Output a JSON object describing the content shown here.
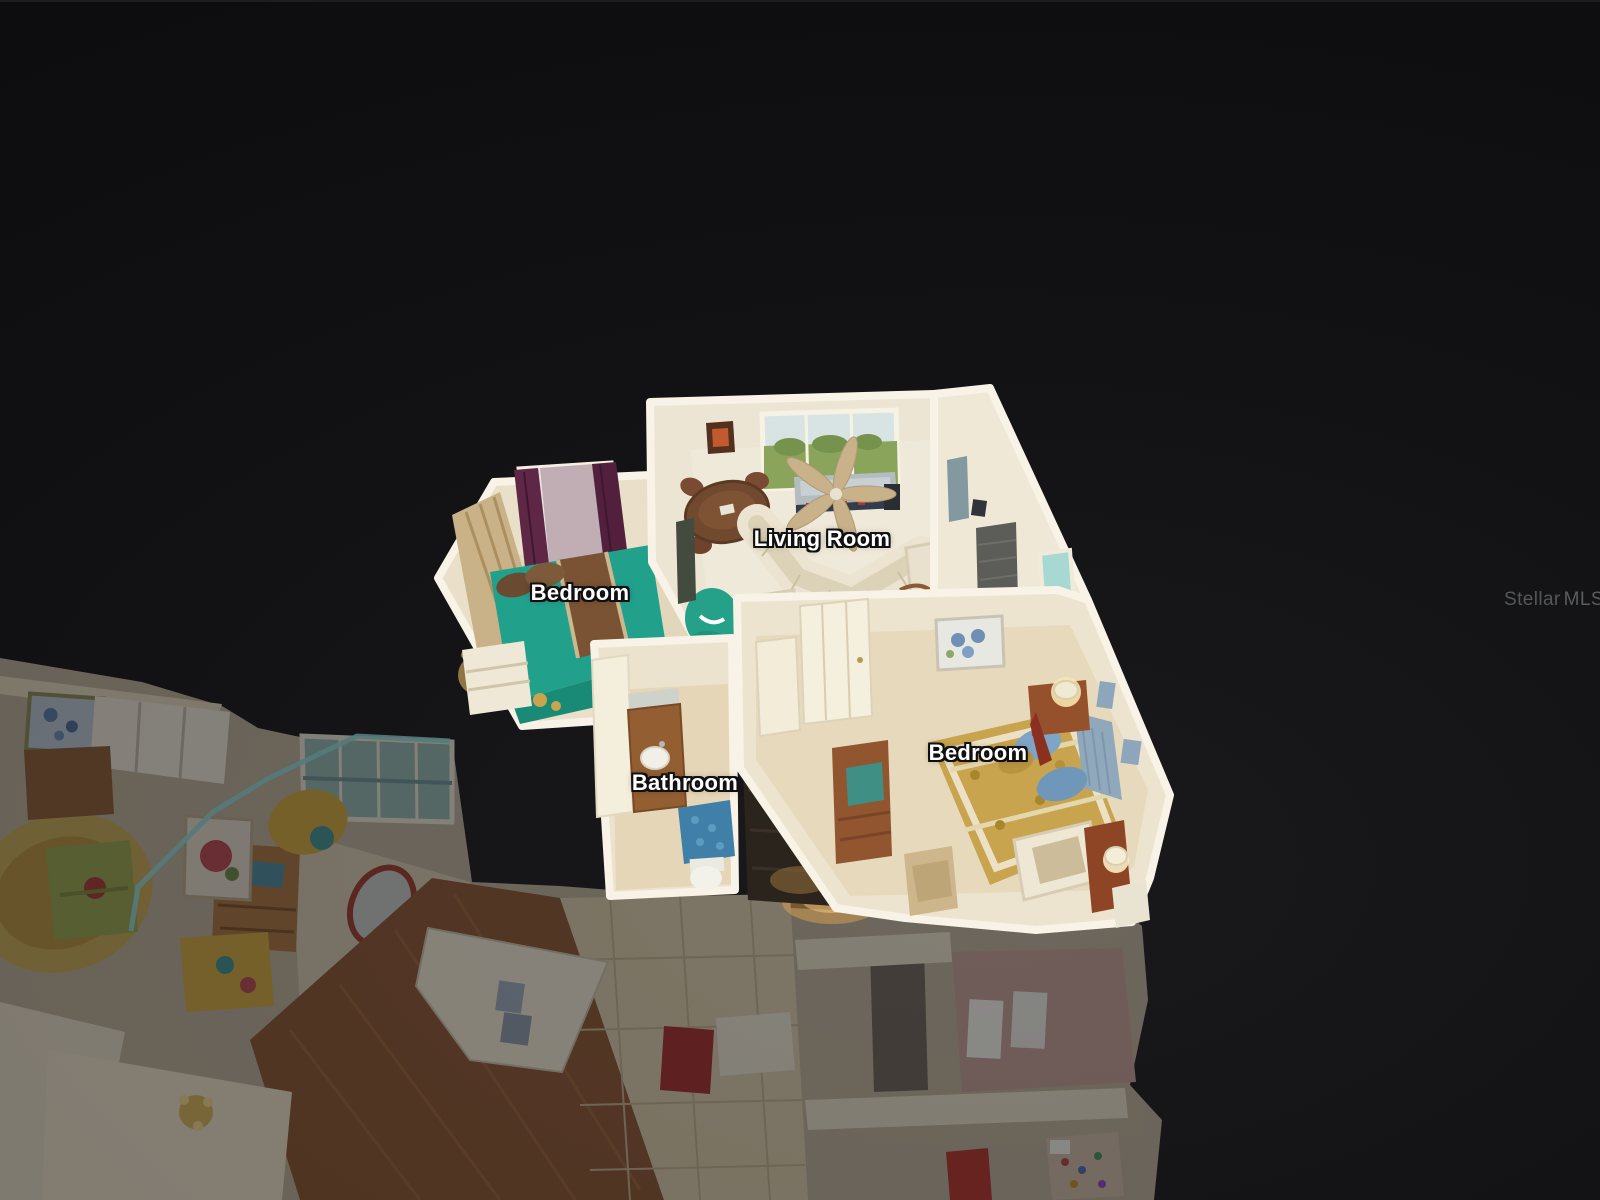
{
  "app": {
    "name": "3D dollhouse home tour viewer",
    "view_mode": "dollhouse"
  },
  "room_labels": [
    {
      "id": "living-room",
      "text": "Living Room",
      "x": 822,
      "y": 539
    },
    {
      "id": "bedroom-1",
      "text": "Bedroom",
      "x": 580,
      "y": 593
    },
    {
      "id": "bathroom",
      "text": "Bathroom",
      "x": 685,
      "y": 783
    },
    {
      "id": "bedroom-2",
      "text": "Bedroom",
      "x": 978,
      "y": 753
    }
  ],
  "watermark": {
    "brand": "Stellar",
    "suffix": "MLS",
    "color": "#55575b"
  },
  "palette": {
    "background": "#101013",
    "label_text": "#ffffff",
    "label_outline": "#101010",
    "wall_bright": "#f6f1e2",
    "carpet_bright": "#ece5d3",
    "teal_bed": "#21a18c",
    "teal_beanbag": "#25a189",
    "gold_bed": "#c9a44e",
    "maroon_curtain": "#5e2745",
    "wood_floor_dim": "#8a5430",
    "grass_view": "#8aa45c",
    "sky_view": "#d8e3e4",
    "blue_rug": "#4080a8"
  }
}
